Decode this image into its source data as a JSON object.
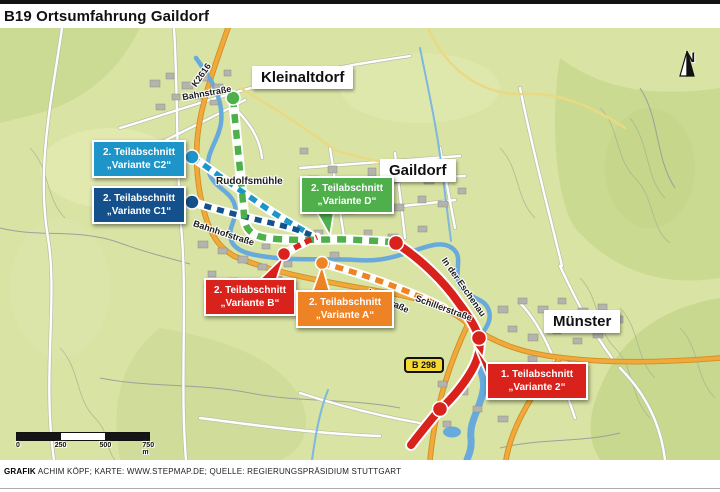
{
  "title": "B19 Ortsumfahrung Gaildorf",
  "towns": {
    "kleinaltdorf": "Kleinaltdorf",
    "gaildorf": "Gaildorf",
    "muenster": "Münster"
  },
  "streets": {
    "k2616": "K2616",
    "bahnstrasse": "Bahnstraße",
    "rudolfsmuehle": "Rudolfsmühle",
    "bahnhofstrasse": "Bahnhofstraße",
    "karlstrasse": "Karlstraße",
    "schillerstrasse": "Schillerstraße",
    "in_der_eschenau": "In der Eschenau"
  },
  "road_badge": "B 298",
  "compass": "N",
  "scale_bar": {
    "t0": "0",
    "t1": "250",
    "t2": "500",
    "t3": "750 m"
  },
  "callouts": {
    "c2": {
      "line1": "2. Teilabschnitt",
      "line2": "„Variante C2“",
      "color": "#1e95c8"
    },
    "c1": {
      "line1": "2. Teilabschnitt",
      "line2": "„Variante C1“",
      "color": "#14518c"
    },
    "d": {
      "line1": "2. Teilabschnitt",
      "line2": "„Variante D“",
      "color": "#4fb04b"
    },
    "b": {
      "line1": "2. Teilabschnitt",
      "line2": "„Variante B“",
      "color": "#d9221c"
    },
    "a": {
      "line1": "2. Teilabschnitt",
      "line2": "„Variante A“",
      "color": "#ee8325"
    },
    "z": {
      "line1": "1. Teilabschnitt",
      "line2": "„Variante 2“",
      "color": "#d9221c"
    }
  },
  "colors": {
    "route_c2": "#1e95c8",
    "route_c1": "#14518c",
    "route_d": "#4fb04b",
    "route_a": "#ee8325",
    "route_red": "#d9221c",
    "badge_bg": "#f5d831",
    "river": "#68aadb",
    "road_orange": "#f2a93b"
  },
  "credits": {
    "label": "GRAFIK",
    "text": "ACHIM KÖPF; KARTE: WWW.STEPMAP.DE; QUELLE: REGIERUNGSPRÄSIDIUM STUTTGART"
  }
}
